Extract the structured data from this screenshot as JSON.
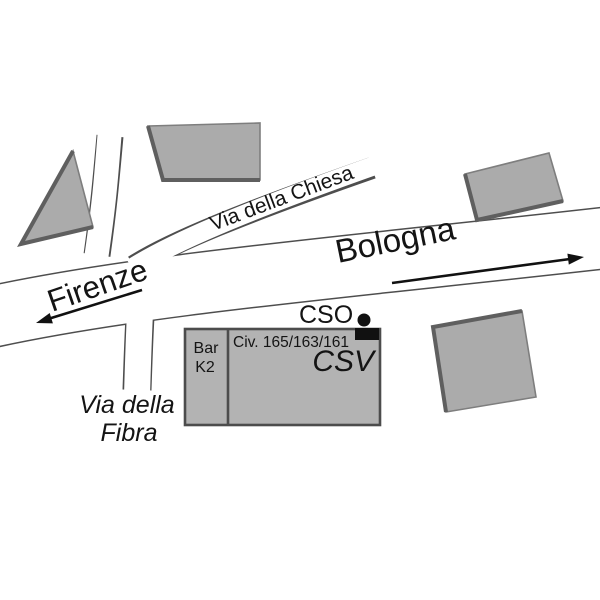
{
  "map": {
    "title": "street sketch map",
    "destinations": {
      "west": "Firenze",
      "east": "Bologna"
    },
    "streets": {
      "chiesa": "Via della Chiesa",
      "fibra_line1": "Via della",
      "fibra_line2": "Fibra"
    },
    "places": {
      "cso": "CSO",
      "csv": "CSV",
      "civic_numbers": "Civ. 165/163/161",
      "bar_line1": "Bar",
      "bar_line2": "K2"
    },
    "colors": {
      "background": "#ffffff",
      "road_fill": "#ffffff",
      "road_edge": "#4e4e4e",
      "building_fill": "#ababab",
      "main_building_fill": "#b3b3b3",
      "building_shadow": "#5f5f5f",
      "text": "#141414",
      "marker": "#111111"
    }
  }
}
